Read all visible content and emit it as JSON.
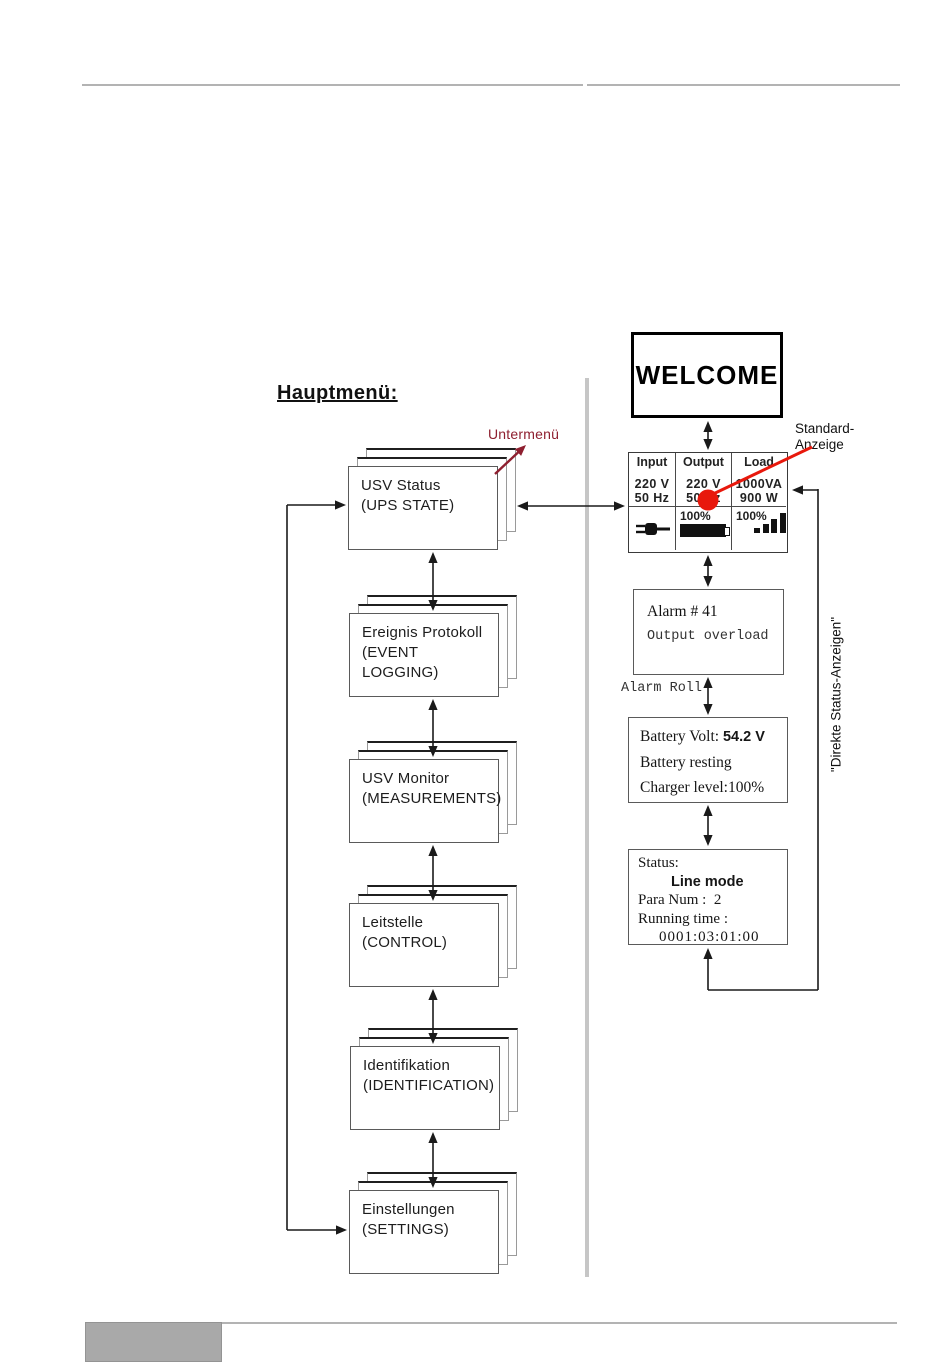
{
  "left": {
    "heading": "Hauptmenü:",
    "untermenu_label": "Untermenü",
    "menu_items": [
      {
        "de": "USV Status",
        "en": "(UPS STATE)"
      },
      {
        "de": "Ereignis Protokoll",
        "en": "(EVENT LOGGING)"
      },
      {
        "de": "USV Monitor",
        "en": "(MEASUREMENTS)"
      },
      {
        "de": "Leitstelle",
        "en": "(CONTROL)"
      },
      {
        "de": "Identifikation",
        "en": "(IDENTIFICATION)"
      },
      {
        "de": "Einstellungen",
        "en": "(SETTINGS)"
      }
    ]
  },
  "right": {
    "welcome": "WELCOME",
    "standard_label_line1": "Standard-",
    "standard_label_line2": "Anzeige",
    "display": {
      "columns": [
        {
          "header": "Input",
          "line1": "220 V",
          "line2": "50 Hz"
        },
        {
          "header": "Output",
          "line1": "220 V",
          "line2": "50 Hz"
        },
        {
          "header": "Load",
          "line1": "1000VA",
          "line2": "900 W"
        }
      ],
      "battery_percent": "100%",
      "load_percent": "100%",
      "icons": [
        "plug-icon",
        "battery-icon",
        "load-bars-icon"
      ]
    },
    "alarm": {
      "line1": "Alarm # 41",
      "line2": "Output overload"
    },
    "alarm_roll_label": "Alarm Roll",
    "battery_box": {
      "label1": "Battery Volt: ",
      "value1": "54.2 V",
      "line2": "Battery resting",
      "line3": "Charger level:100%"
    },
    "status_box": {
      "line1": "Status:",
      "line2": "Line mode",
      "line3": "Para Num :  2",
      "line4": "Running time :",
      "line5": "0001:03:01:00"
    },
    "direkte_label": "\"Direkte Status-Anzeigen\""
  },
  "colors": {
    "accent_red": "#e8180c",
    "untermenu_red": "#8e1f2f",
    "divider_gray": "#c6c6c6",
    "footer_gray": "#a9a9a9",
    "line_black": "#1a1a1a"
  }
}
